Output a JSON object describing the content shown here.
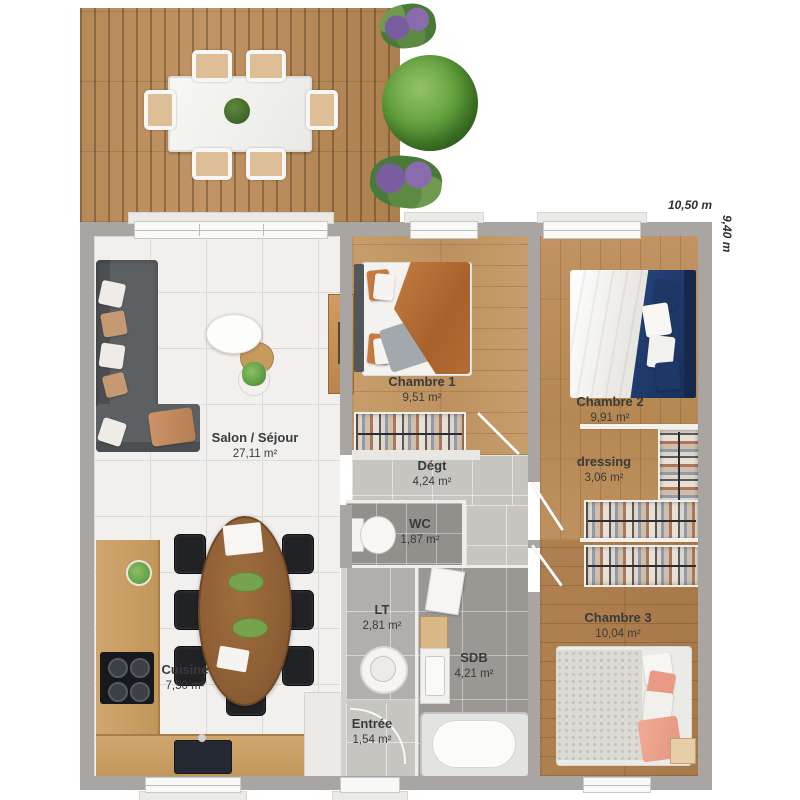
{
  "dimensions": {
    "width": "10,50 m",
    "height": "9,40 m"
  },
  "rooms": {
    "salon": {
      "name": "Salon / Séjour",
      "area": "27,11 m²"
    },
    "cuisine": {
      "name": "Cuisine",
      "area": "7,50 m²"
    },
    "chambre1": {
      "name": "Chambre 1",
      "area": "9,51 m²"
    },
    "chambre2": {
      "name": "Chambre 2",
      "area": "9,91 m²"
    },
    "chambre3": {
      "name": "Chambre 3",
      "area": "10,04 m²"
    },
    "dressing": {
      "name": "dressing",
      "area": "3,06 m²"
    },
    "degt": {
      "name": "Dégt",
      "area": "4,24 m²"
    },
    "wc": {
      "name": "WC",
      "area": "1,87 m²"
    },
    "lt": {
      "name": "LT",
      "area": "2,81 m²"
    },
    "sdb": {
      "name": "SDB",
      "area": "4,21 m²"
    },
    "entree": {
      "name": "Entrée",
      "area": "1,54 m²"
    }
  },
  "colors": {
    "wall": "#a8a5a2",
    "terrace_wood": "#b68a58",
    "floor_wood": "#bd9260",
    "tile_white": "#f1f0ee",
    "tile_gray": "#93908c",
    "sofa": "#5a5d5f",
    "bed1_duvet": "#a9612c",
    "bed2_duvet": "#18305c",
    "bed3_accent": "#e89a85",
    "plant_green": "#62a03c",
    "label_text": "#3a3a3a"
  }
}
